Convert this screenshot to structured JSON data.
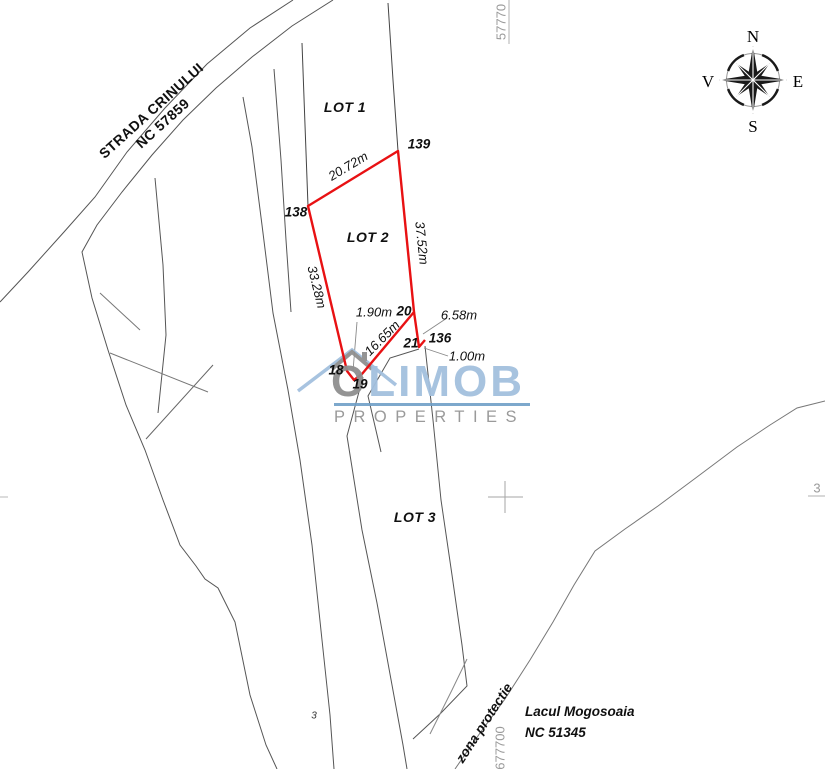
{
  "map": {
    "street": {
      "line1": "STRADA CRINULUI",
      "line2": "NC 57859"
    },
    "lots": {
      "lot1": "LOT 1",
      "lot2": "LOT 2",
      "lot3": "LOT 3"
    },
    "points": {
      "p138": "138",
      "p139": "139",
      "p20": "20",
      "p21": "21",
      "p136": "136",
      "p18": "18",
      "p19": "19"
    },
    "measurements": {
      "top": "20.72m",
      "right": "37.52m",
      "left": "33.28m",
      "diag": "16.65m",
      "m190": "1.90m",
      "m658": "6.58m",
      "m100": "1.00m"
    },
    "grid": {
      "top": "57770",
      "bottom": "677700",
      "right_clipped": "3",
      "stray": "3"
    },
    "lake": {
      "line1": "Lacul Mogosoaia",
      "line2": "NC 51345"
    },
    "zone_label": "zona protectie",
    "compass": {
      "n": "N",
      "e": "E",
      "s": "S",
      "v": "V"
    },
    "watermark": {
      "brand_first": "O",
      "brand_rest": "LIMOB",
      "tagline": "PROPERTIES"
    }
  },
  "colors": {
    "parcel_red": "#e81113",
    "boundary_gray": "#555555",
    "grid_gray": "#a6a6a6",
    "watermark_blue": "#a3c0de",
    "watermark_gray": "#8f8f8f",
    "watermark_rule_blue": "#6f9ec7"
  }
}
